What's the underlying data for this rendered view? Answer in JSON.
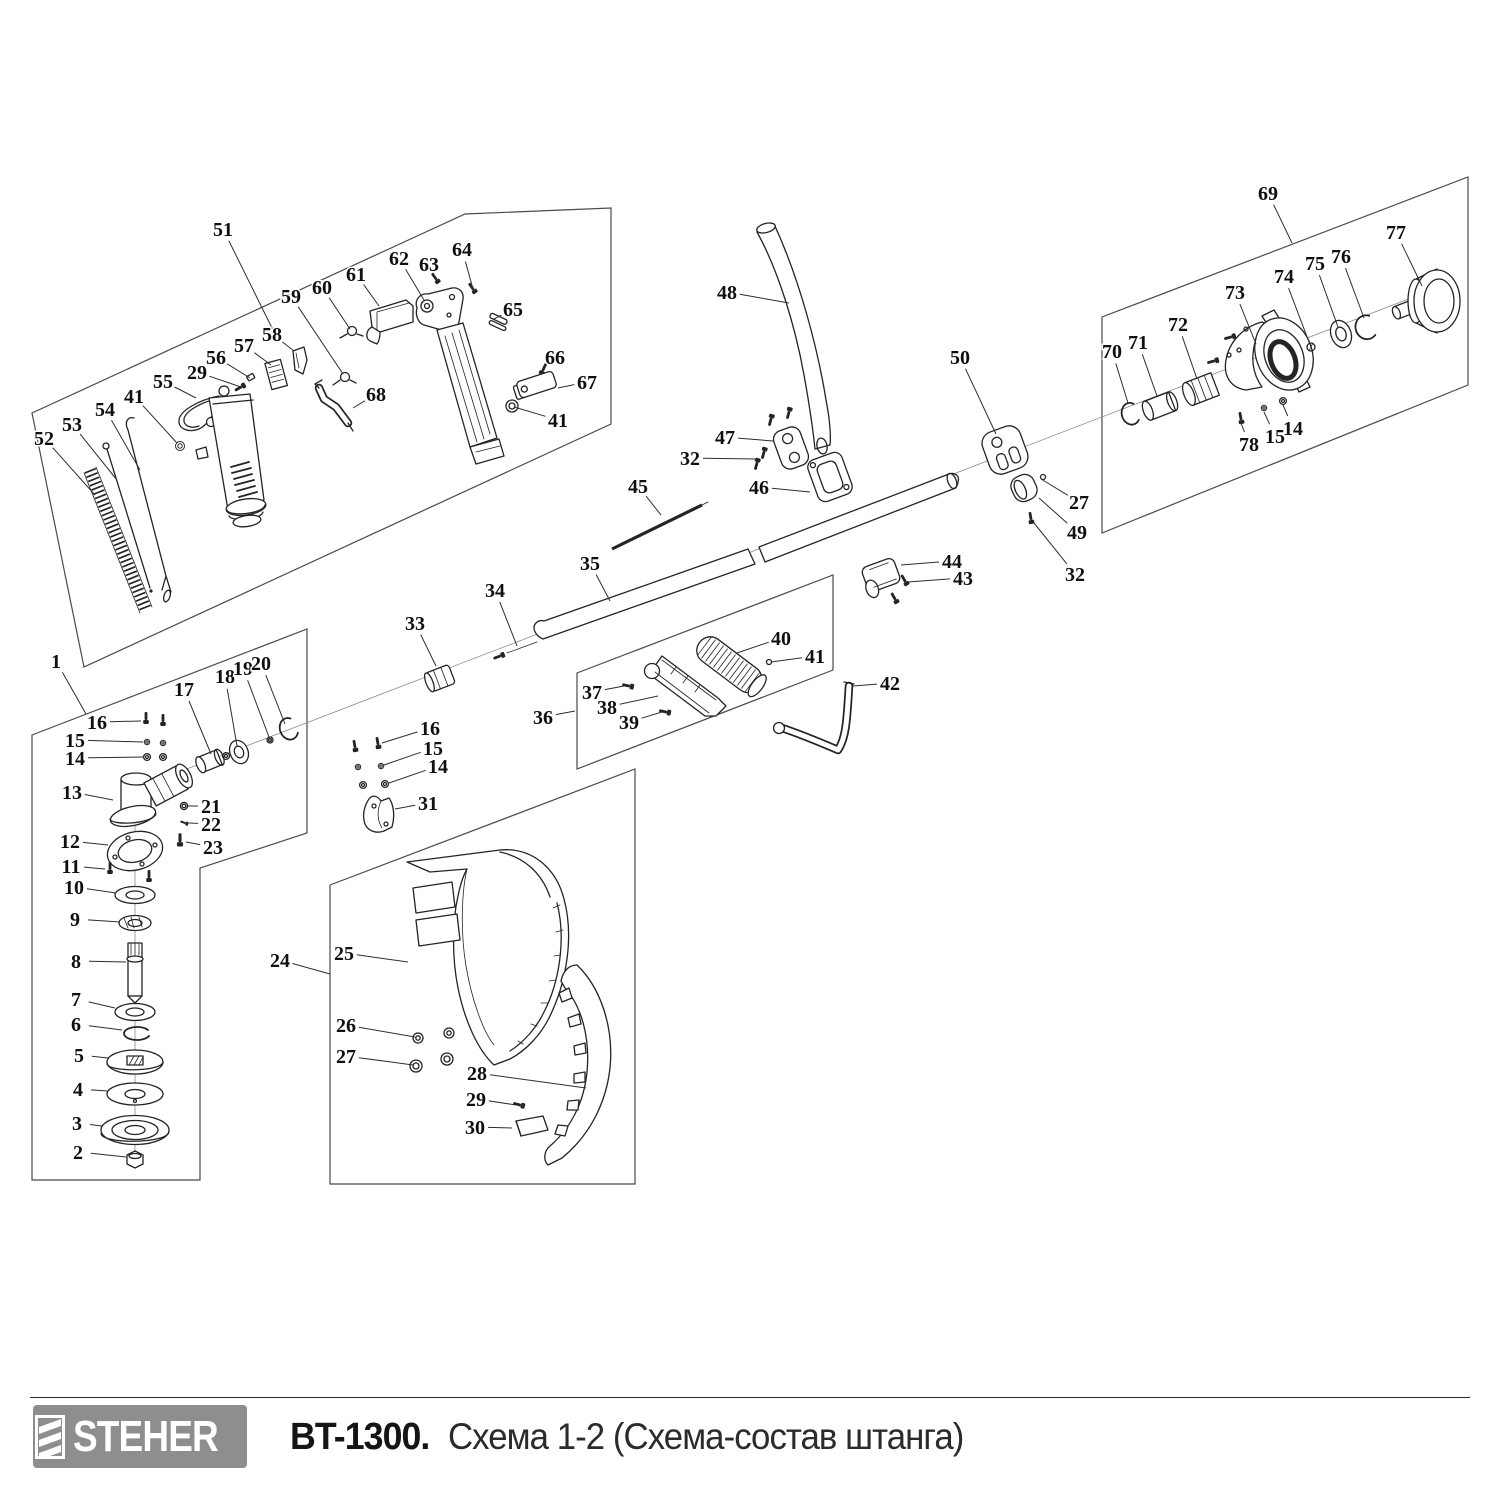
{
  "footer": {
    "brand": "STEHER",
    "model": "BT-1300.",
    "subtitle": "Схема 1-2 (Схема-состав штанга)"
  },
  "colors": {
    "line_art": "#242424",
    "box_outline": "#4a4a4a",
    "logo_background": "#8d8e90",
    "logo_text": "#ffffff",
    "title_text": "#151515"
  },
  "callouts": [
    {
      "n": "51",
      "x": 223,
      "y": 229,
      "tx": 273,
      "ty": 330
    },
    {
      "n": "52",
      "x": 44,
      "y": 438,
      "tx": 95,
      "ty": 495
    },
    {
      "n": "53",
      "x": 72,
      "y": 424,
      "tx": 117,
      "ty": 480
    },
    {
      "n": "54",
      "x": 105,
      "y": 409,
      "tx": 140,
      "ty": 470
    },
    {
      "n": "41",
      "x": 134,
      "y": 396,
      "tx": 177,
      "ty": 443
    },
    {
      "n": "55",
      "x": 163,
      "y": 381,
      "tx": 196,
      "ty": 398
    },
    {
      "n": "29",
      "x": 197,
      "y": 372,
      "tx": 241,
      "ty": 387
    },
    {
      "n": "56",
      "x": 216,
      "y": 357,
      "tx": 250,
      "ty": 378
    },
    {
      "n": "57",
      "x": 244,
      "y": 345,
      "tx": 271,
      "ty": 365
    },
    {
      "n": "58",
      "x": 272,
      "y": 334,
      "tx": 294,
      "ty": 351
    },
    {
      "n": "59",
      "x": 291,
      "y": 296,
      "tx": 343,
      "ty": 374
    },
    {
      "n": "60",
      "x": 322,
      "y": 287,
      "tx": 350,
      "ty": 329
    },
    {
      "n": "61",
      "x": 356,
      "y": 274,
      "tx": 379,
      "ty": 306
    },
    {
      "n": "62",
      "x": 399,
      "y": 258,
      "tx": 424,
      "ty": 300
    },
    {
      "n": "63",
      "x": 429,
      "y": 264,
      "tx": 436,
      "ty": 279
    },
    {
      "n": "64",
      "x": 462,
      "y": 249,
      "tx": 473,
      "ty": 289
    },
    {
      "n": "65",
      "x": 513,
      "y": 309,
      "tx": 494,
      "ty": 319
    },
    {
      "n": "66",
      "x": 555,
      "y": 357,
      "tx": 543,
      "ty": 369
    },
    {
      "n": "67",
      "x": 587,
      "y": 382,
      "tx": 558,
      "ty": 388
    },
    {
      "n": "68",
      "x": 376,
      "y": 394,
      "tx": 353,
      "ty": 408
    },
    {
      "n": "41",
      "x": 558,
      "y": 420,
      "tx": 514,
      "ty": 407
    },
    {
      "n": "1",
      "x": 56,
      "y": 661,
      "tx": 86,
      "ty": 714
    },
    {
      "n": "16",
      "x": 97,
      "y": 722,
      "tx": 141,
      "ty": 721
    },
    {
      "n": "15",
      "x": 75,
      "y": 740,
      "tx": 143,
      "ty": 742
    },
    {
      "n": "14",
      "x": 75,
      "y": 758,
      "tx": 143,
      "ty": 757
    },
    {
      "n": "13",
      "x": 72,
      "y": 792,
      "tx": 113,
      "ty": 800
    },
    {
      "n": "12",
      "x": 70,
      "y": 841,
      "tx": 108,
      "ty": 845
    },
    {
      "n": "11",
      "x": 71,
      "y": 866,
      "tx": 105,
      "ty": 869
    },
    {
      "n": "10",
      "x": 74,
      "y": 887,
      "tx": 116,
      "ty": 893
    },
    {
      "n": "9",
      "x": 75,
      "y": 919,
      "tx": 120,
      "ty": 922
    },
    {
      "n": "8",
      "x": 76,
      "y": 961,
      "tx": 126,
      "ty": 962
    },
    {
      "n": "7",
      "x": 76,
      "y": 999,
      "tx": 115,
      "ty": 1008
    },
    {
      "n": "6",
      "x": 76,
      "y": 1024,
      "tx": 122,
      "ty": 1030
    },
    {
      "n": "5",
      "x": 79,
      "y": 1055,
      "tx": 108,
      "ty": 1058
    },
    {
      "n": "4",
      "x": 78,
      "y": 1089,
      "tx": 108,
      "ty": 1091
    },
    {
      "n": "3",
      "x": 77,
      "y": 1123,
      "tx": 102,
      "ty": 1126
    },
    {
      "n": "2",
      "x": 78,
      "y": 1152,
      "tx": 126,
      "ty": 1157
    },
    {
      "n": "17",
      "x": 184,
      "y": 689,
      "tx": 211,
      "ty": 754
    },
    {
      "n": "18",
      "x": 225,
      "y": 676,
      "tx": 237,
      "ty": 746
    },
    {
      "n": "19",
      "x": 243,
      "y": 668,
      "tx": 269,
      "ty": 737
    },
    {
      "n": "20",
      "x": 261,
      "y": 663,
      "tx": 285,
      "ty": 724
    },
    {
      "n": "21",
      "x": 211,
      "y": 806,
      "tx": 188,
      "ty": 806
    },
    {
      "n": "22",
      "x": 211,
      "y": 824,
      "tx": 189,
      "ty": 823
    },
    {
      "n": "23",
      "x": 213,
      "y": 847,
      "tx": 186,
      "ty": 842
    },
    {
      "n": "16",
      "x": 430,
      "y": 728,
      "tx": 382,
      "ty": 743
    },
    {
      "n": "15",
      "x": 433,
      "y": 748,
      "tx": 384,
      "ty": 765
    },
    {
      "n": "14",
      "x": 438,
      "y": 766,
      "tx": 389,
      "ty": 783
    },
    {
      "n": "31",
      "x": 428,
      "y": 803,
      "tx": 395,
      "ty": 809
    },
    {
      "n": "24",
      "x": 280,
      "y": 960,
      "tx": 330,
      "ty": 974
    },
    {
      "n": "25",
      "x": 344,
      "y": 953,
      "tx": 408,
      "ty": 962
    },
    {
      "n": "26",
      "x": 346,
      "y": 1025,
      "tx": 415,
      "ty": 1037
    },
    {
      "n": "27",
      "x": 346,
      "y": 1056,
      "tx": 413,
      "ty": 1065
    },
    {
      "n": "28",
      "x": 477,
      "y": 1073,
      "tx": 586,
      "ty": 1088
    },
    {
      "n": "29",
      "x": 476,
      "y": 1099,
      "tx": 516,
      "ty": 1105
    },
    {
      "n": "30",
      "x": 475,
      "y": 1127,
      "tx": 512,
      "ty": 1128
    },
    {
      "n": "33",
      "x": 415,
      "y": 623,
      "tx": 436,
      "ty": 666
    },
    {
      "n": "34",
      "x": 495,
      "y": 590,
      "tx": 517,
      "ty": 646
    },
    {
      "n": "35",
      "x": 590,
      "y": 563,
      "tx": 610,
      "ty": 601
    },
    {
      "n": "36",
      "x": 543,
      "y": 717,
      "tx": 575,
      "ty": 711
    },
    {
      "n": "37",
      "x": 592,
      "y": 692,
      "tx": 624,
      "ty": 686
    },
    {
      "n": "38",
      "x": 607,
      "y": 707,
      "tx": 658,
      "ty": 696
    },
    {
      "n": "39",
      "x": 629,
      "y": 722,
      "tx": 662,
      "ty": 712
    },
    {
      "n": "40",
      "x": 781,
      "y": 638,
      "tx": 737,
      "ty": 653
    },
    {
      "n": "41",
      "x": 815,
      "y": 656,
      "tx": 771,
      "ty": 662
    },
    {
      "n": "42",
      "x": 890,
      "y": 683,
      "tx": 853,
      "ty": 686
    },
    {
      "n": "43",
      "x": 963,
      "y": 578,
      "tx": 908,
      "ty": 582
    },
    {
      "n": "44",
      "x": 952,
      "y": 561,
      "tx": 901,
      "ty": 565
    },
    {
      "n": "45",
      "x": 638,
      "y": 486,
      "tx": 661,
      "ty": 515
    },
    {
      "n": "46",
      "x": 759,
      "y": 487,
      "tx": 810,
      "ty": 492
    },
    {
      "n": "47",
      "x": 725,
      "y": 437,
      "tx": 773,
      "ty": 441
    },
    {
      "n": "32",
      "x": 690,
      "y": 458,
      "tx": 757,
      "ty": 459
    },
    {
      "n": "48",
      "x": 727,
      "y": 292,
      "tx": 789,
      "ty": 303
    },
    {
      "n": "50",
      "x": 960,
      "y": 357,
      "tx": 996,
      "ty": 434
    },
    {
      "n": "27",
      "x": 1079,
      "y": 502,
      "tx": 1041,
      "ty": 479
    },
    {
      "n": "49",
      "x": 1077,
      "y": 532,
      "tx": 1039,
      "ty": 498
    },
    {
      "n": "32",
      "x": 1075,
      "y": 574,
      "tx": 1034,
      "ty": 523
    },
    {
      "n": "69",
      "x": 1268,
      "y": 193,
      "tx": 1292,
      "ty": 243
    },
    {
      "n": "70",
      "x": 1112,
      "y": 351,
      "tx": 1128,
      "ty": 403
    },
    {
      "n": "71",
      "x": 1138,
      "y": 342,
      "tx": 1157,
      "ty": 396
    },
    {
      "n": "72",
      "x": 1178,
      "y": 324,
      "tx": 1197,
      "ty": 379
    },
    {
      "n": "73",
      "x": 1235,
      "y": 292,
      "tx": 1256,
      "ty": 344
    },
    {
      "n": "74",
      "x": 1284,
      "y": 276,
      "tx": 1309,
      "ty": 342
    },
    {
      "n": "75",
      "x": 1315,
      "y": 263,
      "tx": 1338,
      "ty": 327
    },
    {
      "n": "76",
      "x": 1341,
      "y": 256,
      "tx": 1364,
      "ty": 318
    },
    {
      "n": "77",
      "x": 1396,
      "y": 232,
      "tx": 1422,
      "ty": 286
    },
    {
      "n": "78",
      "x": 1249,
      "y": 444,
      "tx": 1241,
      "ty": 423
    },
    {
      "n": "15",
      "x": 1275,
      "y": 436,
      "tx": 1264,
      "ty": 412
    },
    {
      "n": "14",
      "x": 1293,
      "y": 428,
      "tx": 1283,
      "ty": 405
    }
  ]
}
